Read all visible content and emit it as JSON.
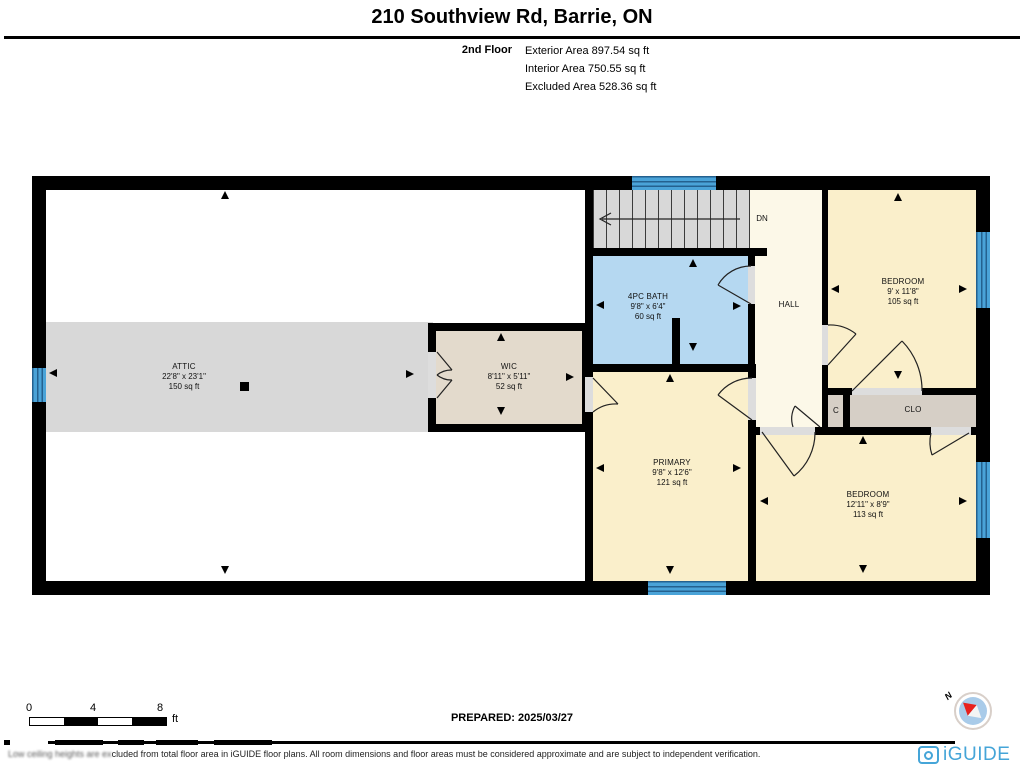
{
  "header": {
    "title": "210 Southview Rd, Barrie, ON",
    "floor_label": "2nd Floor",
    "areas": [
      "Exterior Area 897.54 sq ft",
      "Interior Area 750.55 sq ft",
      "Excluded Area 528.36 sq ft"
    ]
  },
  "plan": {
    "stairs_label": "DN",
    "rooms": [
      {
        "name": "ATTIC",
        "dims": "22'8\" x 23'1\"",
        "area": "150 sq ft"
      },
      {
        "name": "WIC",
        "dims": "8'11\" x 5'11\"",
        "area": "52 sq ft"
      },
      {
        "name": "4PC BATH",
        "dims": "9'8\" x 6'4\"",
        "area": "60 sq ft"
      },
      {
        "name": "HALL",
        "dims": "",
        "area": ""
      },
      {
        "name": "BEDROOM",
        "dims": "9' x 11'8\"",
        "area": "105 sq ft"
      },
      {
        "name": "C",
        "dims": "",
        "area": ""
      },
      {
        "name": "CLO",
        "dims": "",
        "area": ""
      },
      {
        "name": "PRIMARY",
        "dims": "9'8\" x 12'6\"",
        "area": "121 sq ft"
      },
      {
        "name": "BEDROOM",
        "dims": "12'11\" x 8'9\"",
        "area": "113 sq ft"
      }
    ]
  },
  "footer": {
    "scale_ticks": [
      "0",
      "4",
      "8"
    ],
    "scale_unit": "ft",
    "prepared": "PREPARED: 2025/03/27",
    "disclaimer_obscured": "Low ceiling heights are ex",
    "disclaimer_visible": "cluded from total floor area in iGUIDE floor plans. All room dimensions and floor areas must be considered approximate and are subject to independent verification.",
    "compass_label": "N",
    "brand": "iGUIDE"
  },
  "colors": {
    "wall": "#000000",
    "attic_gray": "#d8d8d8",
    "wic_tan": "#e3dacc",
    "closet_tan": "#d6cfc6",
    "bath_blue": "#b5d8f1",
    "hall_cream": "#fcf8e8",
    "bedroom_yellow": "#faefcb",
    "window_blue": "#4aa3d8",
    "brand_blue": "#45a5d8",
    "compass_red": "#e8211d"
  }
}
